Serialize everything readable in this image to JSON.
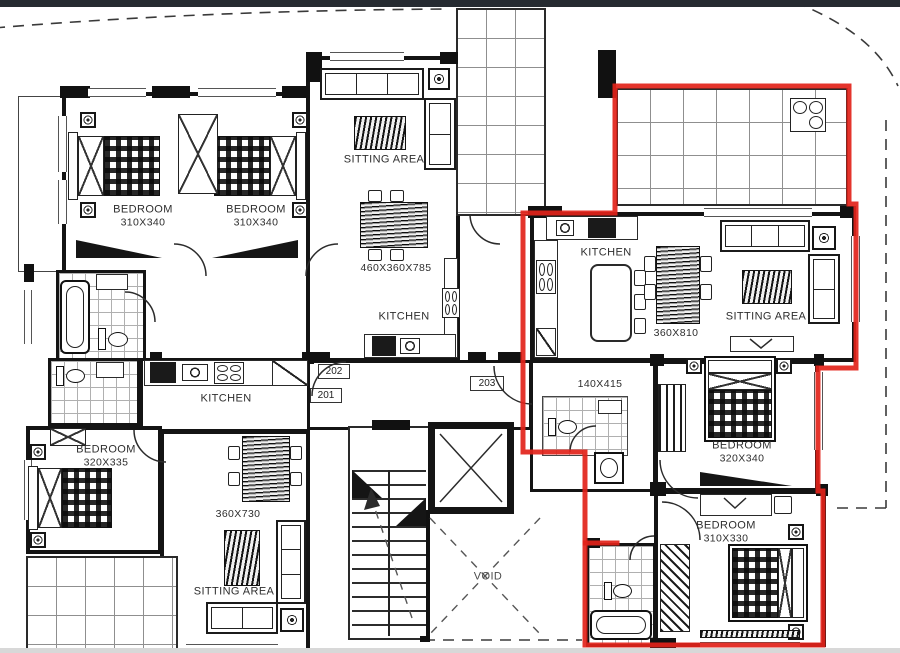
{
  "colors": {
    "outline_red": "#e2231a",
    "wall": "#141414",
    "topbar": "#262b31",
    "text": "#2e2e2e"
  },
  "units": {
    "u201": "201",
    "u202": "202",
    "u203": "203"
  },
  "labels": {
    "bedroom_tl1": {
      "name": "BEDROOM",
      "dim": "310X340"
    },
    "bedroom_tl2": {
      "name": "BEDROOM",
      "dim": "310X340"
    },
    "sitting_top": {
      "name": "SITTING AREA"
    },
    "dining_top": {
      "dim": "460X360X785"
    },
    "kitchen_mid": {
      "name": "KITCHEN"
    },
    "kitchen_right": {
      "name": "KITCHEN"
    },
    "dining_right": {
      "dim": "360X810"
    },
    "sitting_right": {
      "name": "SITTING AREA"
    },
    "hall_right": {
      "dim": "140X415"
    },
    "bedroom_r1": {
      "name": "BEDROOM",
      "dim": "320X340"
    },
    "bedroom_r2": {
      "name": "BEDROOM",
      "dim": "310X330"
    },
    "kitchen_left": {
      "name": "KITCHEN"
    },
    "bedroom_left": {
      "name": "BEDROOM",
      "dim": "320X335"
    },
    "dining_left": {
      "dim": "360X730"
    },
    "sitting_bottom": {
      "name": "SITTING AREA"
    },
    "void": {
      "name": "VOID"
    }
  },
  "annotation": {
    "color": "#e2231a",
    "outline_points": "615,213 615,86 849,86 849,204 856,204 856,368 818,368 818,491 823,491 823,645 585,645 585,452 523,452 523,213",
    "spur_points": "585,543 617,543"
  }
}
